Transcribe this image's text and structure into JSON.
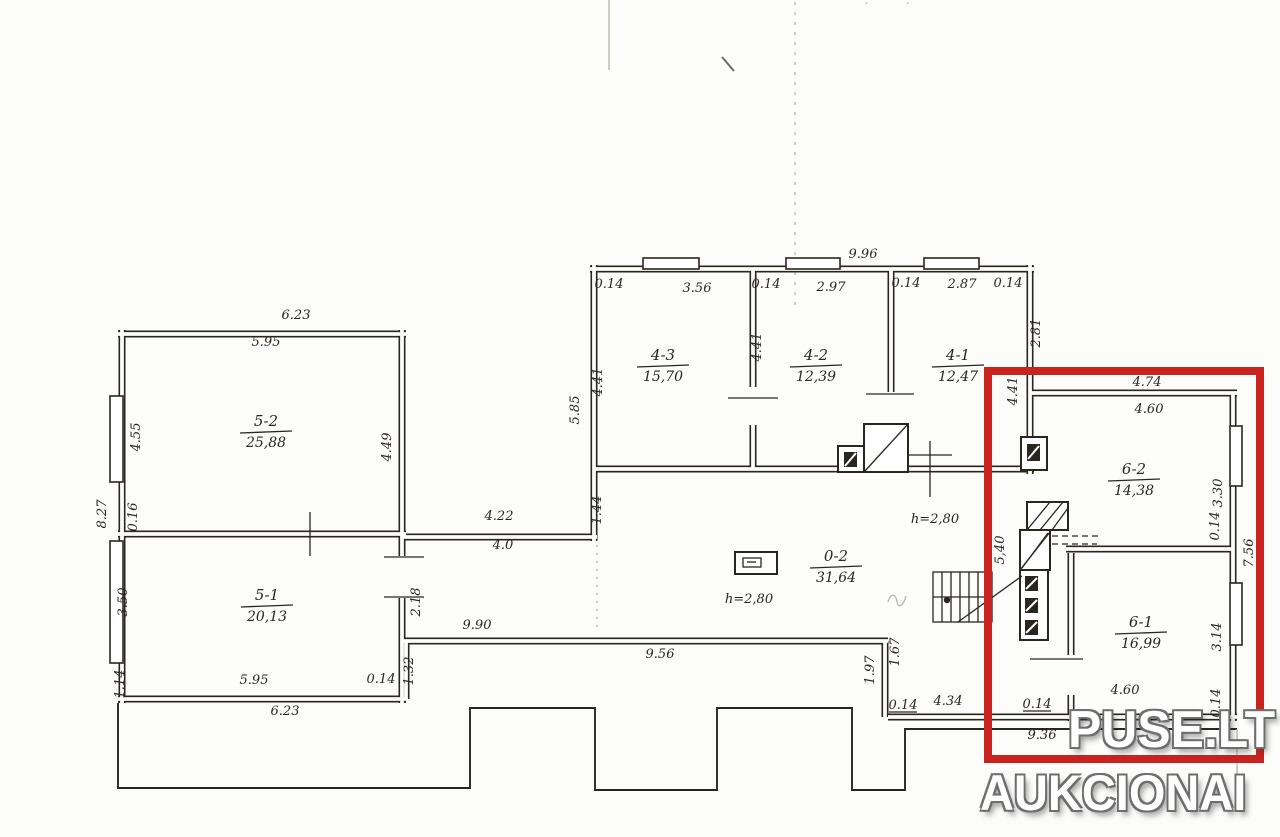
{
  "watermark": {
    "line1": "PUSE.LT",
    "line2": "AUKCIONAI"
  },
  "scan_artifacts": {
    "top_note": "''','' ''''','' ''"
  },
  "colors": {
    "ink": "#29261f",
    "faint": "#b8b3a8",
    "paper": "#fcfcfa",
    "red": "#c92320",
    "watermark_outline": "#6e6e6e"
  },
  "rooms": [
    {
      "label": "5-2",
      "area": "25,88",
      "cx": 266,
      "cy": 432
    },
    {
      "label": "5-1",
      "area": "20,13",
      "cx": 267,
      "cy": 606
    },
    {
      "label": "4-3",
      "area": "15,70",
      "cx": 663,
      "cy": 366
    },
    {
      "label": "4-2",
      "area": "12,39",
      "cx": 816,
      "cy": 366
    },
    {
      "label": "4-1",
      "area": "12,47",
      "cx": 958,
      "cy": 366
    },
    {
      "label": "0-2",
      "area": "31,64",
      "cx": 836,
      "cy": 567
    },
    {
      "label": "6-2",
      "area": "14,38",
      "cx": 1134,
      "cy": 480
    },
    {
      "label": "6-1",
      "area": "16,99",
      "cx": 1141,
      "cy": 633
    }
  ],
  "dimensions": [
    {
      "t": "9.96",
      "x": 863,
      "y": 258
    },
    {
      "t": "0.14",
      "x": 609,
      "y": 288
    },
    {
      "t": "3.56",
      "x": 697,
      "y": 292
    },
    {
      "t": "0.14",
      "x": 766,
      "y": 288
    },
    {
      "t": "2.97",
      "x": 831,
      "y": 291
    },
    {
      "t": "0.14",
      "x": 906,
      "y": 287
    },
    {
      "t": "2.87",
      "x": 962,
      "y": 288
    },
    {
      "t": "0.14",
      "x": 1008,
      "y": 287
    },
    {
      "t": "5.85",
      "x": 579,
      "y": 410,
      "r": -90
    },
    {
      "t": "4.41",
      "x": 602,
      "y": 382,
      "r": -90
    },
    {
      "t": "4.41",
      "x": 761,
      "y": 347,
      "r": -90
    },
    {
      "t": "2.81",
      "x": 1040,
      "y": 333,
      "r": -90
    },
    {
      "t": "4.41",
      "x": 1017,
      "y": 391,
      "r": -90
    },
    {
      "t": "6.23",
      "x": 296,
      "y": 319
    },
    {
      "t": "5.95",
      "x": 266,
      "y": 346
    },
    {
      "t": "4.55",
      "x": 140,
      "y": 437,
      "r": -90
    },
    {
      "t": "4.49",
      "x": 391,
      "y": 447,
      "r": -90
    },
    {
      "t": "8.27",
      "x": 106,
      "y": 514,
      "r": -90
    },
    {
      "t": "0.16",
      "x": 137,
      "y": 517,
      "r": -90
    },
    {
      "t": "3.50",
      "x": 127,
      "y": 602,
      "r": -90
    },
    {
      "t": "1.14",
      "x": 124,
      "y": 684,
      "r": -90
    },
    {
      "t": "5.95",
      "x": 254,
      "y": 684
    },
    {
      "t": "0.14",
      "x": 381,
      "y": 683
    },
    {
      "t": "6.23",
      "x": 285,
      "y": 715
    },
    {
      "t": "4.22",
      "x": 499,
      "y": 520
    },
    {
      "t": "4.0",
      "x": 503,
      "y": 549
    },
    {
      "t": "1.44",
      "x": 601,
      "y": 510,
      "r": -90
    },
    {
      "t": "2.18",
      "x": 420,
      "y": 602,
      "r": -90
    },
    {
      "t": "9.90",
      "x": 477,
      "y": 629
    },
    {
      "t": "9.56",
      "x": 660,
      "y": 658
    },
    {
      "t": "1.32",
      "x": 413,
      "y": 671,
      "r": -90
    },
    {
      "t": "h=2,80",
      "x": 749,
      "y": 603
    },
    {
      "t": "h=2,80",
      "x": 935,
      "y": 523
    },
    {
      "t": "1.97",
      "x": 874,
      "y": 670,
      "r": -90
    },
    {
      "t": "1.67",
      "x": 899,
      "y": 652,
      "r": -90
    },
    {
      "t": "0.14",
      "x": 903,
      "y": 709,
      "u": 1
    },
    {
      "t": "4.34",
      "x": 948,
      "y": 705
    },
    {
      "t": "5,40",
      "x": 1004,
      "y": 550,
      "r": -90
    },
    {
      "t": "4.74",
      "x": 1147,
      "y": 386
    },
    {
      "t": "4.60",
      "x": 1149,
      "y": 413
    },
    {
      "t": "3.30",
      "x": 1222,
      "y": 493,
      "r": -90
    },
    {
      "t": "0.14",
      "x": 1219,
      "y": 526,
      "r": -90
    },
    {
      "t": "7.56",
      "x": 1253,
      "y": 553,
      "r": -90
    },
    {
      "t": "3.14",
      "x": 1221,
      "y": 637,
      "r": -90
    },
    {
      "t": "0.14",
      "x": 1220,
      "y": 703,
      "r": -90
    },
    {
      "t": "4.60",
      "x": 1125,
      "y": 694
    },
    {
      "t": "0.14",
      "x": 1037,
      "y": 708,
      "u": 1
    },
    {
      "t": "9.36",
      "x": 1042,
      "y": 739
    }
  ]
}
